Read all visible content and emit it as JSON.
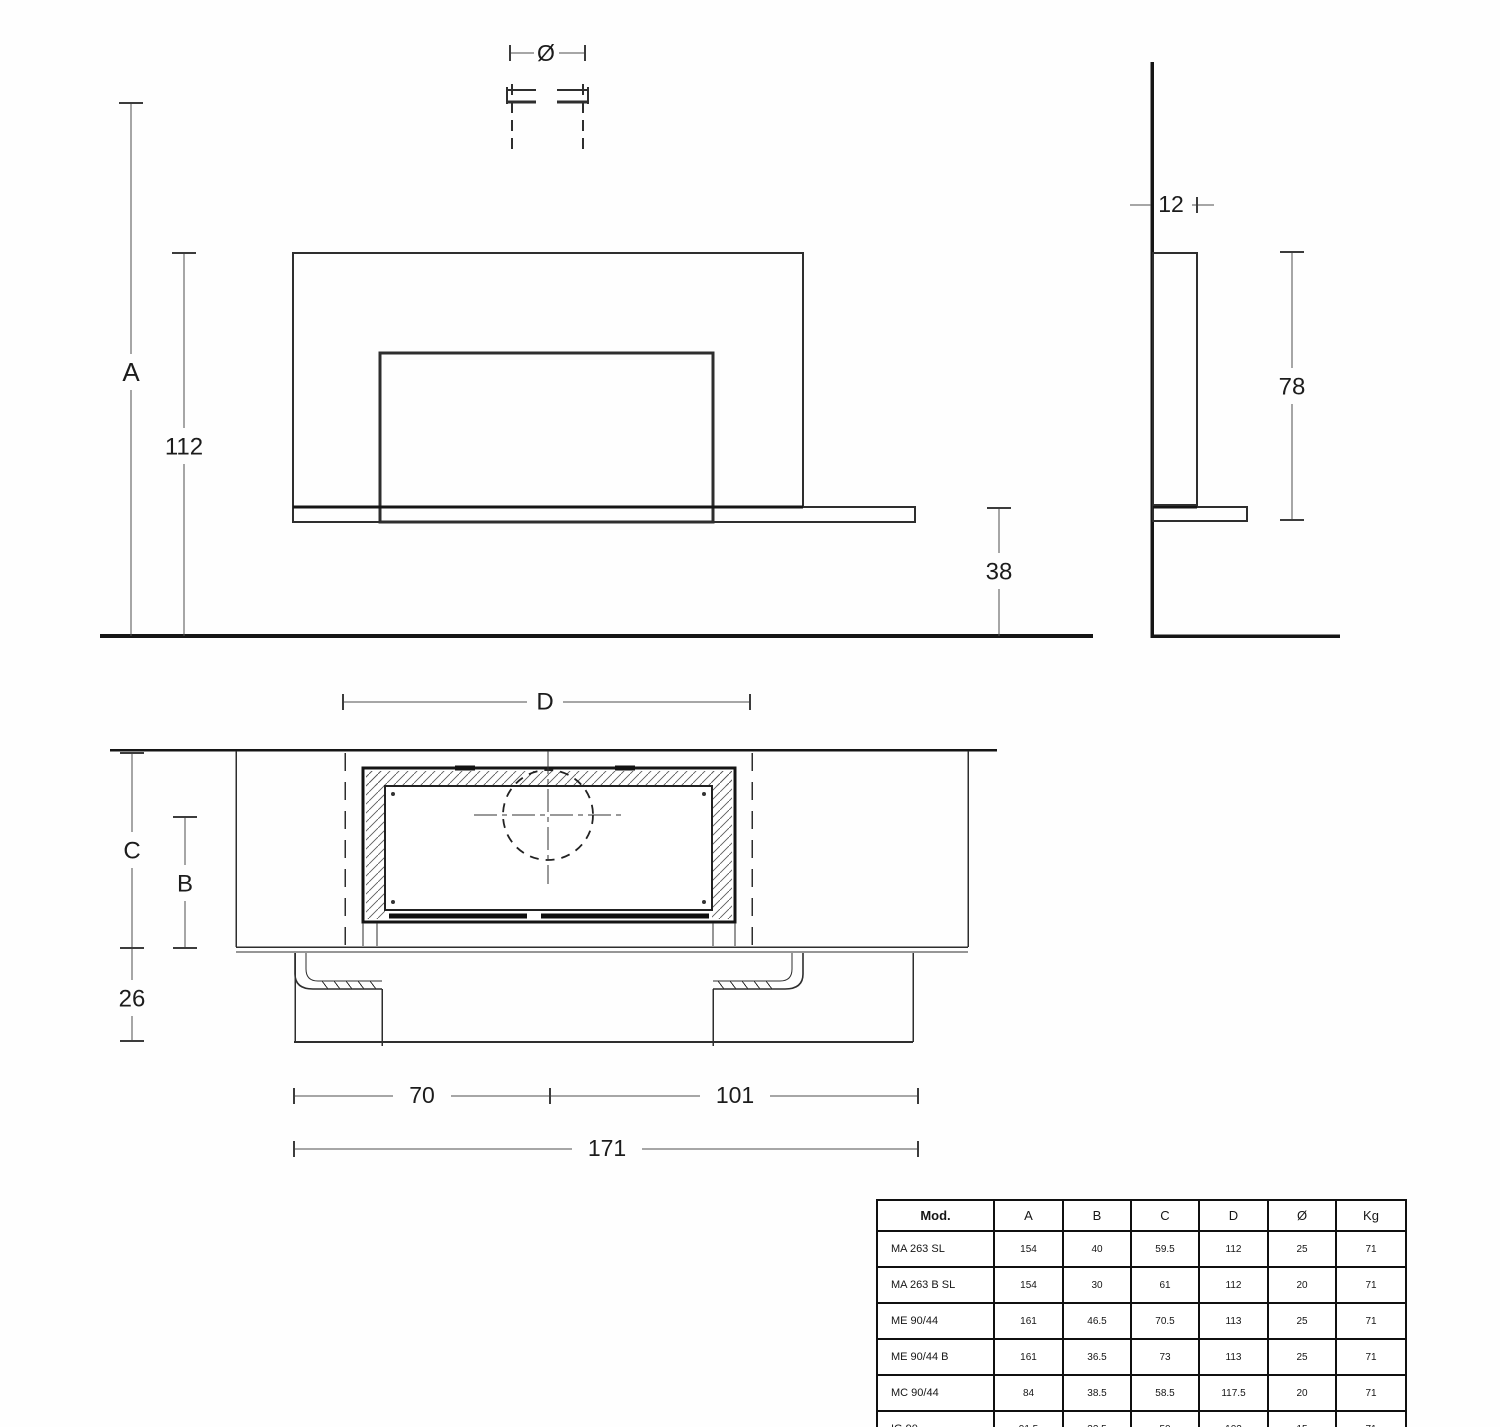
{
  "drawing": {
    "front_view": {
      "flue_diameter_label": "Ø",
      "overall_height_label": "A",
      "panel_top_height": "112",
      "shelf_height": "38"
    },
    "side_view": {
      "panel_depth": "12",
      "panel_height": "78"
    },
    "plan_view": {
      "niche_width_label": "D",
      "wall_to_front_label": "C",
      "axis_to_front_label": "B",
      "hearth_front_depth": "26",
      "left_of_axis_width": "70",
      "right_of_axis_width": "101",
      "total_width": "171"
    }
  },
  "spec_table": {
    "columns": [
      "Mod.",
      "A",
      "B",
      "C",
      "D",
      "Ø",
      "Kg"
    ],
    "rows": [
      {
        "model": "MA 263 SL",
        "values": [
          "154",
          "40",
          "59.5",
          "112",
          "25",
          "71"
        ]
      },
      {
        "model": "MA 263 B SL",
        "values": [
          "154",
          "30",
          "61",
          "112",
          "20",
          "71"
        ]
      },
      {
        "model": "ME 90/44",
        "values": [
          "161",
          "46.5",
          "70.5",
          "113",
          "25",
          "71"
        ]
      },
      {
        "model": "ME 90/44 B",
        "values": [
          "161",
          "36.5",
          "73",
          "113",
          "25",
          "71"
        ]
      },
      {
        "model": "MC 90/44",
        "values": [
          "84",
          "38.5",
          "58.5",
          "117.5",
          "20",
          "71"
        ]
      },
      {
        "model": "IG 90",
        "values": [
          "91.5",
          "32.5",
          "50",
          "102",
          "15",
          "71"
        ]
      }
    ]
  }
}
